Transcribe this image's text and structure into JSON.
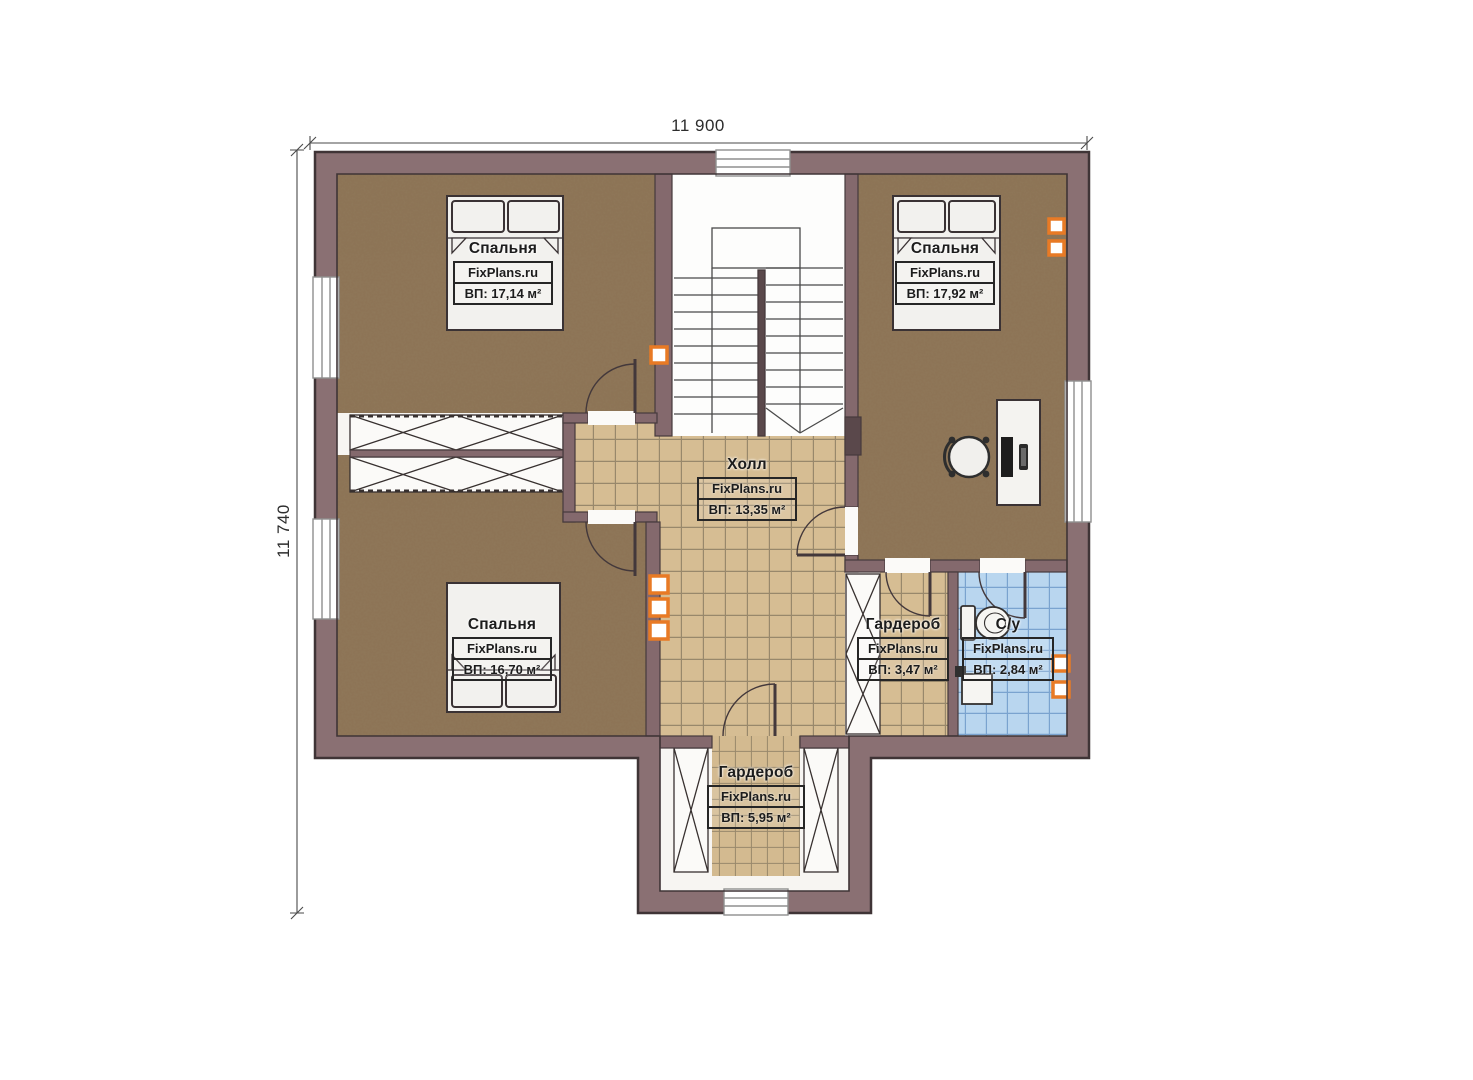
{
  "branding": {
    "watermark": "FixPlans.ru"
  },
  "dimensions": {
    "top": "11 900",
    "left": "11 740"
  },
  "rooms": [
    {
      "id": "bedroom-top-left",
      "name": "Спальня",
      "area_label": "ВП: 17,14 м²"
    },
    {
      "id": "bedroom-top-right",
      "name": "Спальня",
      "area_label": "ВП: 17,92 м²"
    },
    {
      "id": "bedroom-bottom-left",
      "name": "Спальня",
      "area_label": "ВП: 16,70 м²"
    },
    {
      "id": "hall",
      "name": "Холл",
      "area_label": "ВП: 13,35 м²"
    },
    {
      "id": "wardrobe-right",
      "name": "Гардероб",
      "area_label": "ВП: 3,47 м²"
    },
    {
      "id": "bathroom",
      "name": "С/у",
      "area_label": "ВП: 2,84 м²"
    },
    {
      "id": "wardrobe-bottom",
      "name": "Гардероб",
      "area_label": "ВП: 5,95 м²"
    }
  ],
  "colors": {
    "wall": "#8a7073",
    "wall_inner": "#84696d",
    "outline": "#3f3436",
    "carpet": "#8d7456",
    "tile_tan": "#d6bd93",
    "tile_blue": "#b9d6ef",
    "accent_orange": "#e87a25"
  }
}
